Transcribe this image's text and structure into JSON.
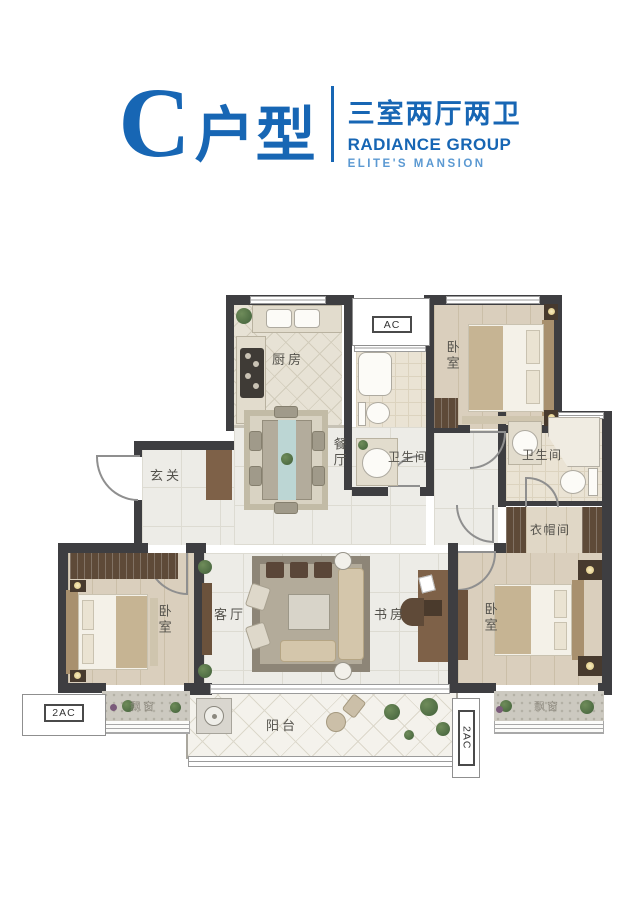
{
  "header": {
    "unit_letter": "C",
    "unit_type_label": "户型",
    "layout_summary": "三室两厅两卫",
    "brand_name": "RADIANCE GROUP",
    "brand_tagline": "ELITE'S MANSION"
  },
  "colors": {
    "accent_blue": "#1766b4",
    "accent_blue_light": "#5b99d2",
    "wall": "#3e3e41"
  },
  "rooms": {
    "kitchen": "厨房",
    "dining": "餐厅",
    "entry": "玄关",
    "living": "客厅",
    "study": "书房",
    "bedroom_top_right": "卧室",
    "bedroom_left": "卧室",
    "bedroom_right": "卧室",
    "bathroom_main": "卫生间",
    "bathroom_master": "卫生间",
    "cloakroom": "衣帽间",
    "balcony": "阳台",
    "bay_window_left": "飘窗",
    "bay_window_right": "飘窗"
  },
  "equipment": {
    "ac_top": "AC",
    "ac_bottom_left": "2AC",
    "ac_bottom_right": "2AC"
  }
}
